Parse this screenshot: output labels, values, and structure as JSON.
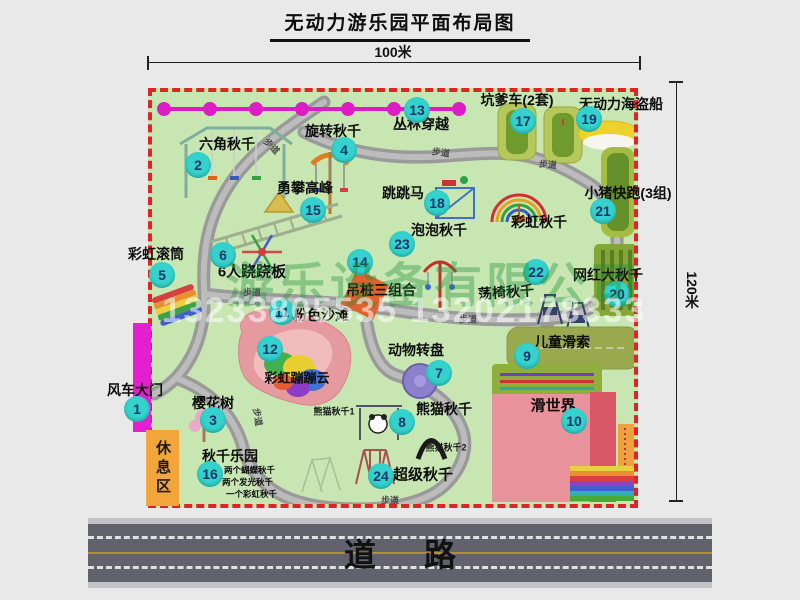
{
  "title": "无动力游乐园平面布局图",
  "dimensions": {
    "width": "100米",
    "height": "120米"
  },
  "road": {
    "label": "道路"
  },
  "watermark": {
    "company": "游乐设备有限公司",
    "phone": "13233805535 13202178333"
  },
  "misc": {
    "path_label": "步道",
    "rest_area": "休息区",
    "rainbow_swing": "彩虹秋千"
  },
  "attractions": [
    {
      "num": "1",
      "label": "风车大门"
    },
    {
      "num": "2",
      "label": "六角秋千"
    },
    {
      "num": "3",
      "label": "樱花树"
    },
    {
      "num": "4",
      "label": "旋转秋千"
    },
    {
      "num": "5",
      "label": "彩虹滚筒"
    },
    {
      "num": "6",
      "label": "6人跷跷板"
    },
    {
      "num": "7",
      "label": "动物转盘"
    },
    {
      "num": "8",
      "label": "熊猫秋千",
      "sub1": "熊猫秋千1",
      "sub2": "熊猫秋千2"
    },
    {
      "num": "9",
      "label": "儿童滑索"
    },
    {
      "num": "10",
      "label": "滑世界"
    },
    {
      "num": "11",
      "label": "粉色沙滩"
    },
    {
      "num": "12",
      "label": "彩虹蹦蹦云"
    },
    {
      "num": "13",
      "label": "丛林穿越"
    },
    {
      "num": "14",
      "label": "吊桩三组合"
    },
    {
      "num": "15",
      "label": "勇攀高峰"
    },
    {
      "num": "16",
      "label": "秋千乐园",
      "notes": [
        "两个蝴蝶秋千",
        "两个发光秋千",
        "一个彩虹秋千"
      ]
    },
    {
      "num": "17",
      "label": "坑爹车(2套)"
    },
    {
      "num": "18",
      "label": "跳跳马"
    },
    {
      "num": "19",
      "label": "无动力海盗船"
    },
    {
      "num": "20",
      "label": "网红大秋千"
    },
    {
      "num": "21",
      "label": "小猪快跑(3组)"
    },
    {
      "num": "22",
      "label": "荡椅秋千"
    },
    {
      "num": "23",
      "label": "泡泡秋千"
    },
    {
      "num": "24",
      "label": "超级秋千"
    }
  ]
}
